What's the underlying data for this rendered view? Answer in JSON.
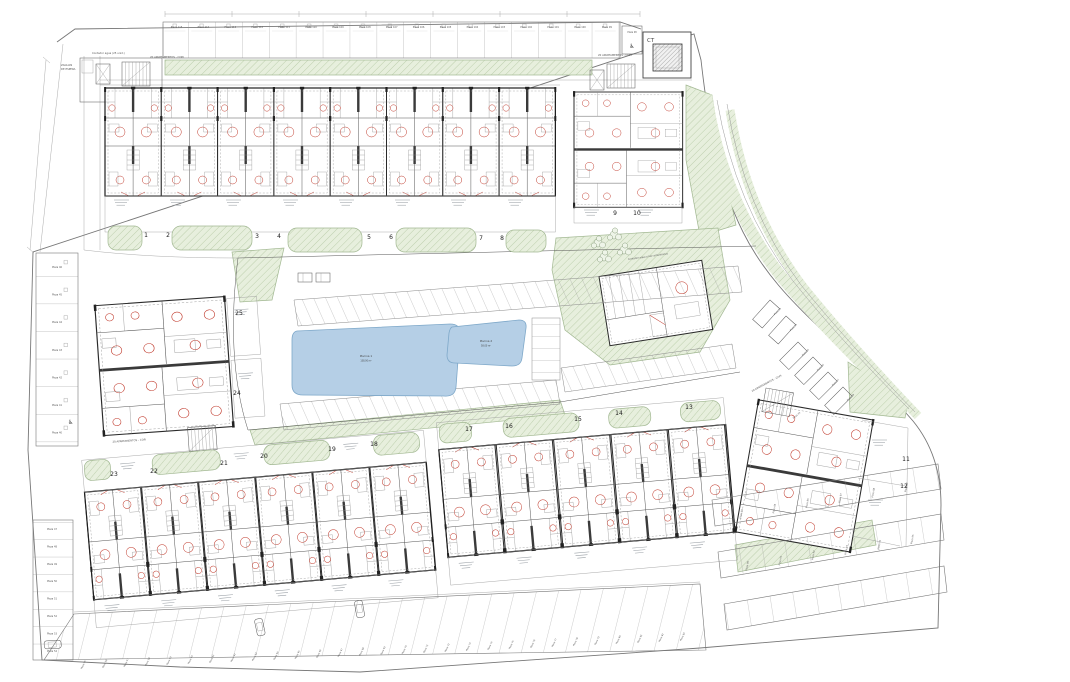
{
  "plan": {
    "transformer_label": "CT",
    "pools": [
      {
        "name": "Piscina 1",
        "area": "138.00 m²"
      },
      {
        "name": "Piscina 2",
        "area": "58.00 m²"
      }
    ],
    "parcel_numbers": [
      "1",
      "2",
      "3",
      "4",
      "5",
      "6",
      "7",
      "8",
      "9",
      "10",
      "11",
      "12",
      "13",
      "14",
      "15",
      "16",
      "17",
      "18",
      "19",
      "20",
      "21",
      "22",
      "23",
      "24",
      "25"
    ],
    "annotations": {
      "zaguan_line1": "ZAGUAN",
      "zaguan_line2": "DE ESPERA",
      "water_meter": "Contador agua (25 unid.)",
      "apartments_note": "20 APARTAMENTOS - COPI",
      "club_meter": "Contador agua y luz comunitarios"
    },
    "parking": {
      "top_row": [
        "Plaza 115",
        "Plaza 114",
        "Plaza 113",
        "Plaza 112",
        "Plaza 111",
        "Plaza 110",
        "Plaza 109",
        "Plaza 108",
        "Plaza 107",
        "Plaza 106",
        "Plaza 105",
        "Plaza 104",
        "Plaza 103",
        "Plaza 102",
        "Plaza 101",
        "Plaza 100",
        "Plaza 99"
      ],
      "top_disabled": "Plaza 98",
      "left_upper": [
        "Plaza 46",
        "Plaza 45",
        "Plaza 44",
        "Plaza 43",
        "Plaza 42",
        "Plaza 41",
        "Plaza 40"
      ],
      "left_lower": [
        "Plaza 47",
        "Plaza 48",
        "Plaza 49",
        "Plaza 50",
        "Plaza 51",
        "Plaza 52",
        "Plaza 53",
        "Plaza 54"
      ],
      "bottom_row": [
        "Plaza 55",
        "Plaza 56",
        "Plaza 57",
        "Plaza 58",
        "Plaza 59",
        "Plaza 60",
        "Plaza 61",
        "Plaza 62",
        "Plaza 63",
        "Plaza 64",
        "Plaza 65",
        "Plaza 66",
        "Plaza 67",
        "Plaza 68",
        "Plaza 69",
        "Plaza 70",
        "Plaza 71",
        "Plaza 72",
        "Plaza 73",
        "Plaza 74",
        "Plaza 75",
        "Plaza 76",
        "Plaza 77",
        "Plaza 78",
        "Plaza 79",
        "Plaza 80",
        "Plaza 81",
        "Plaza 82",
        "Plaza 83"
      ],
      "right_grid_upper": [
        "Plaza 84",
        "Plaza 85",
        "Plaza 86",
        "Plaza 87",
        "Plaza 88",
        "Plaza 89"
      ],
      "right_grid_lower": [
        "Plaza 90",
        "Plaza 91",
        "Plaza 92",
        "Plaza 93",
        "Plaza 94",
        "Plaza 95"
      ],
      "road_extra": [
        "Plaza 33",
        "Plaza 34"
      ],
      "road_spaces": [
        "Plaza 35",
        "Plaza 36",
        "Plaza 37",
        "Plaza 38"
      ],
      "near_block_space": "Plaza 39"
    }
  }
}
